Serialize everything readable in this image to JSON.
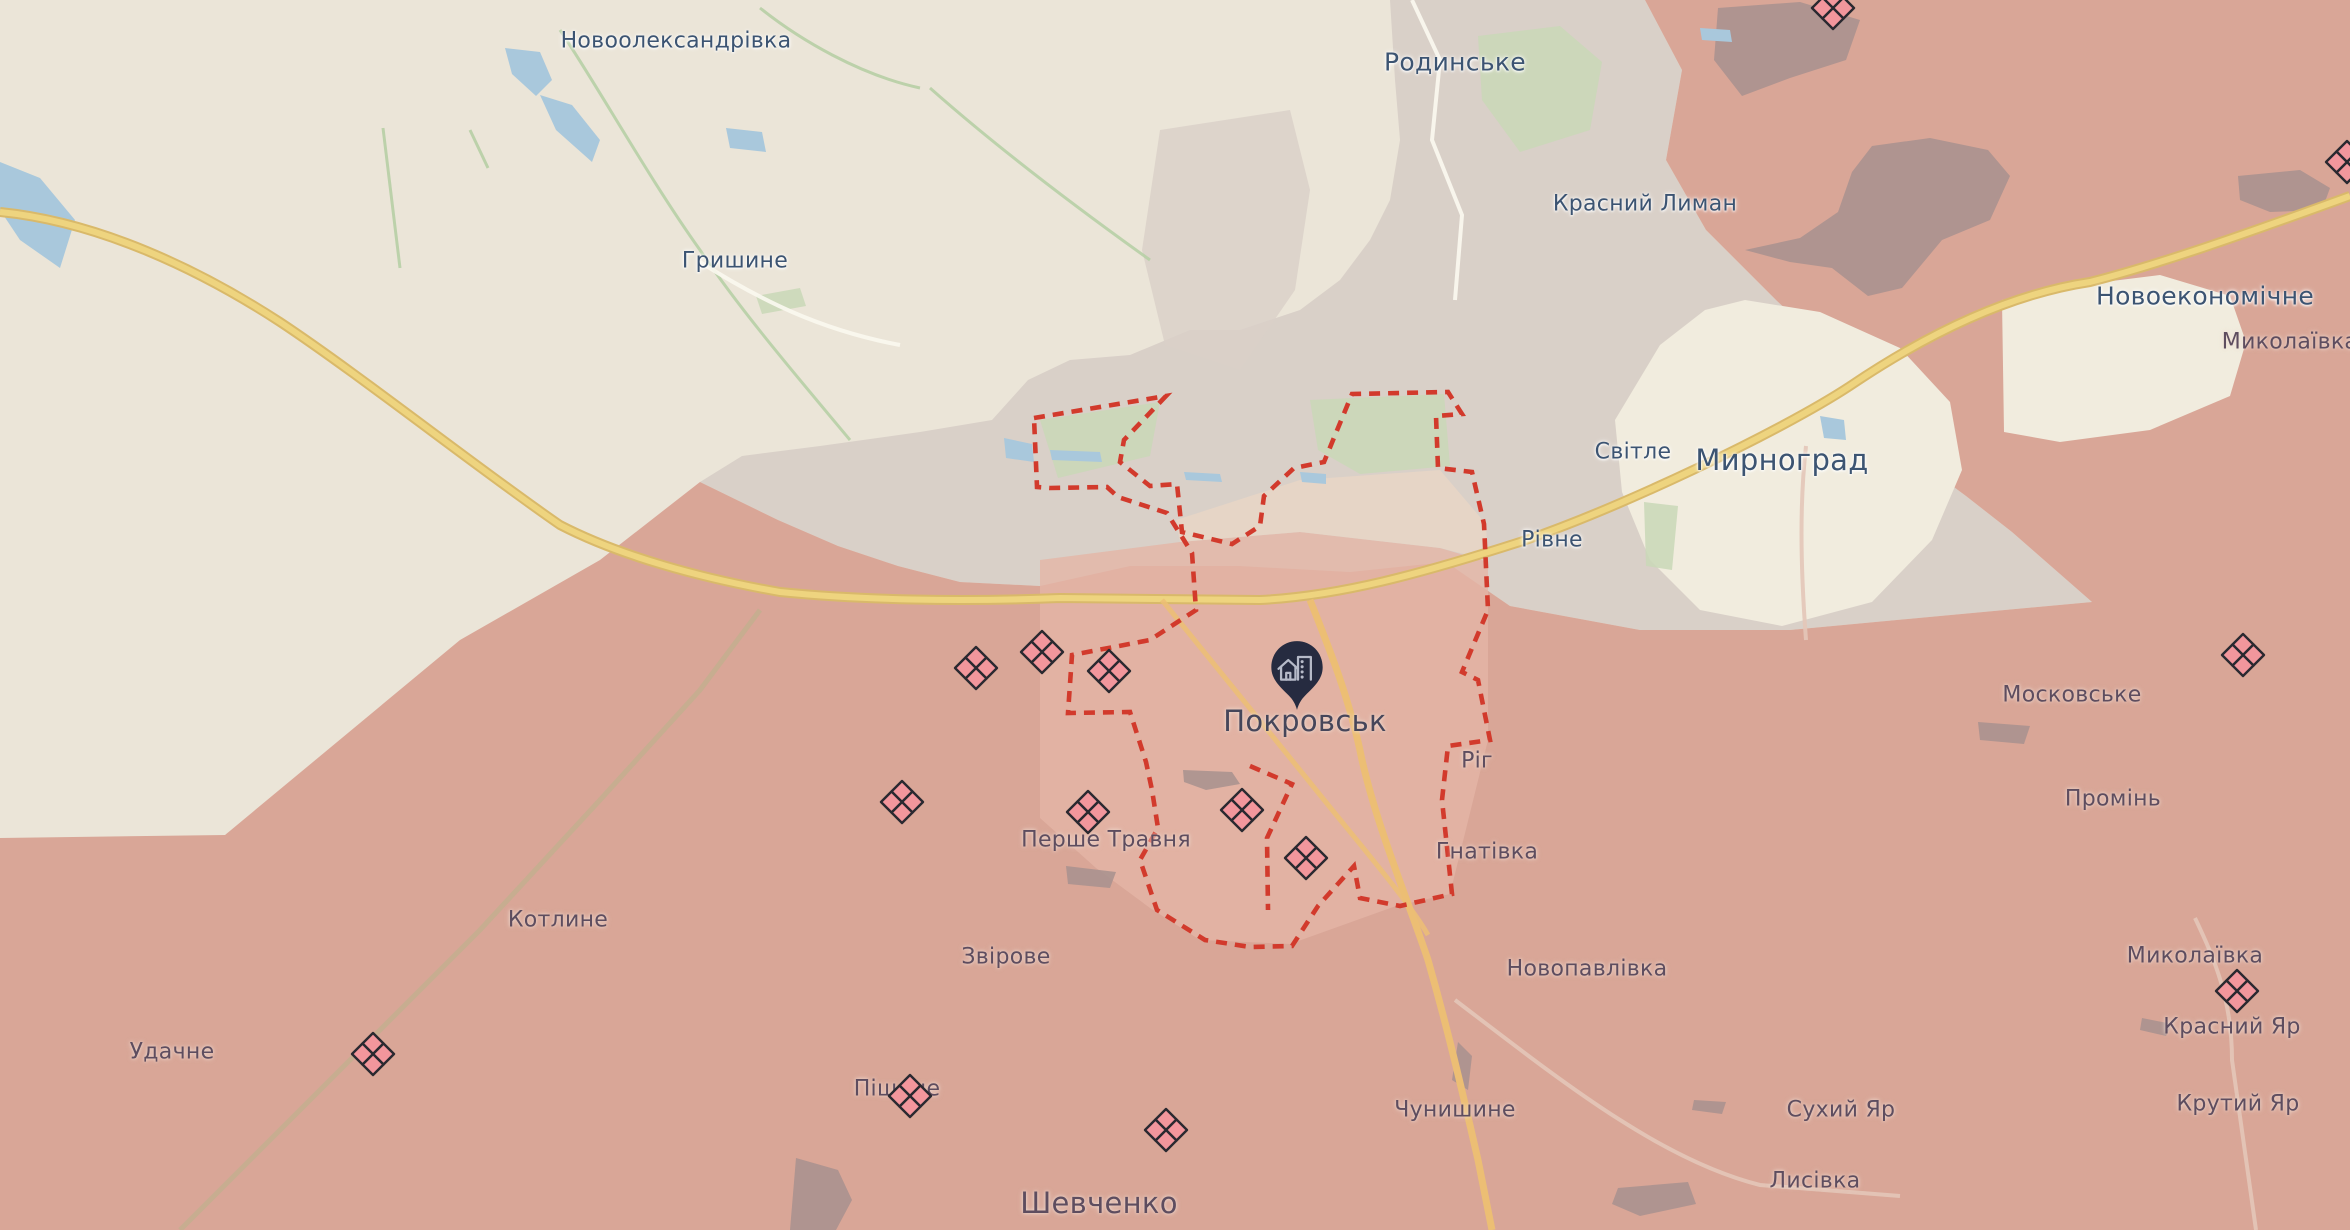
{
  "map": {
    "labels": [
      {
        "text": "Новоолександрівка",
        "x": 676,
        "y": 41,
        "size": "town",
        "zone": "free"
      },
      {
        "text": "Родинське",
        "x": 1455,
        "y": 62,
        "size": "town-lg",
        "zone": "free"
      },
      {
        "text": "Красний Лиман",
        "x": 1645,
        "y": 204,
        "size": "town",
        "zone": "free"
      },
      {
        "text": "Гришине",
        "x": 735,
        "y": 261,
        "size": "town",
        "zone": "free"
      },
      {
        "text": "Новоекономічне",
        "x": 2205,
        "y": 296,
        "size": "town-lg",
        "zone": "free"
      },
      {
        "text": "Миколаївка",
        "x": 2290,
        "y": 342,
        "size": "town",
        "zone": "occ"
      },
      {
        "text": "Світле",
        "x": 1633,
        "y": 452,
        "size": "town",
        "zone": "free"
      },
      {
        "text": "Мирноград",
        "x": 1782,
        "y": 460,
        "size": "city",
        "zone": "free"
      },
      {
        "text": "Рівне",
        "x": 1552,
        "y": 540,
        "size": "town",
        "zone": "free"
      },
      {
        "text": "Московське",
        "x": 2072,
        "y": 695,
        "size": "town",
        "zone": "occ"
      },
      {
        "text": "Покровськ",
        "x": 1305,
        "y": 721,
        "size": "city",
        "zone": "dark"
      },
      {
        "text": "Ріг",
        "x": 1477,
        "y": 761,
        "size": "town",
        "zone": "occ"
      },
      {
        "text": "Промінь",
        "x": 2113,
        "y": 799,
        "size": "town",
        "zone": "occ"
      },
      {
        "text": "Перше Травня",
        "x": 1106,
        "y": 840,
        "size": "town",
        "zone": "occ"
      },
      {
        "text": "Гнатівка",
        "x": 1487,
        "y": 852,
        "size": "town",
        "zone": "occ"
      },
      {
        "text": "Котлине",
        "x": 558,
        "y": 920,
        "size": "town",
        "zone": "occ"
      },
      {
        "text": "Миколаївка",
        "x": 2195,
        "y": 956,
        "size": "town",
        "zone": "occ"
      },
      {
        "text": "Звірове",
        "x": 1006,
        "y": 957,
        "size": "town",
        "zone": "occ"
      },
      {
        "text": "Новопавлівка",
        "x": 1587,
        "y": 969,
        "size": "town",
        "zone": "occ"
      },
      {
        "text": "Красний Яр",
        "x": 2232,
        "y": 1027,
        "size": "town",
        "zone": "occ"
      },
      {
        "text": "Удачне",
        "x": 172,
        "y": 1052,
        "size": "town",
        "zone": "occ"
      },
      {
        "text": "Піщане",
        "x": 897,
        "y": 1089,
        "size": "town",
        "zone": "occ"
      },
      {
        "text": "Сухий Яр",
        "x": 1841,
        "y": 1110,
        "size": "town",
        "zone": "occ"
      },
      {
        "text": "Крутий Яр",
        "x": 2238,
        "y": 1104,
        "size": "town",
        "zone": "occ"
      },
      {
        "text": "Чунишине",
        "x": 1455,
        "y": 1110,
        "size": "town",
        "zone": "occ"
      },
      {
        "text": "Лисівка",
        "x": 1815,
        "y": 1181,
        "size": "town",
        "zone": "occ"
      },
      {
        "text": "Шевченко",
        "x": 1099,
        "y": 1203,
        "size": "city",
        "zone": "occ"
      }
    ],
    "markers": {
      "icon": "clash-quartered-diamond-icon",
      "items": [
        {
          "x": 1833,
          "y": 8
        },
        {
          "x": 2347,
          "y": 162
        },
        {
          "x": 2243,
          "y": 655
        },
        {
          "x": 976,
          "y": 668
        },
        {
          "x": 1042,
          "y": 652
        },
        {
          "x": 1109,
          "y": 671
        },
        {
          "x": 902,
          "y": 802
        },
        {
          "x": 1088,
          "y": 812
        },
        {
          "x": 1242,
          "y": 810
        },
        {
          "x": 1306,
          "y": 858
        },
        {
          "x": 373,
          "y": 1054
        },
        {
          "x": 910,
          "y": 1096
        },
        {
          "x": 1166,
          "y": 1130
        },
        {
          "x": 2237,
          "y": 991
        }
      ]
    },
    "pin": {
      "icon": "city-location-pin-icon",
      "x": 1297,
      "y": 712
    }
  },
  "colors": {
    "base": "#ebe5d8",
    "grey_zone": "#d9d0c8",
    "occupied": "#d9a697",
    "occupied_inner": "#e4b5a6",
    "pocket_cream": "#f1ecde",
    "forest_occupied": "#a7908e",
    "green": "#c9d8b7",
    "water": "#a9c8dc",
    "road_yellow": "#eed47f",
    "road_yellow_casing": "#d9b96a",
    "road_orange": "#ecbe74",
    "road_faint": "#e3c6b8",
    "rail_brown": "#c4ae8f",
    "boundary_red": "#d23a2c",
    "marker_fill": "#f2969c",
    "marker_stroke": "#2a2930",
    "pin_fill": "#262b40",
    "pin_glyph": "#b6bac8",
    "label_free": "#3c5472",
    "label_occupied": "#5e4d5f",
    "label_dark": "#46465a"
  }
}
